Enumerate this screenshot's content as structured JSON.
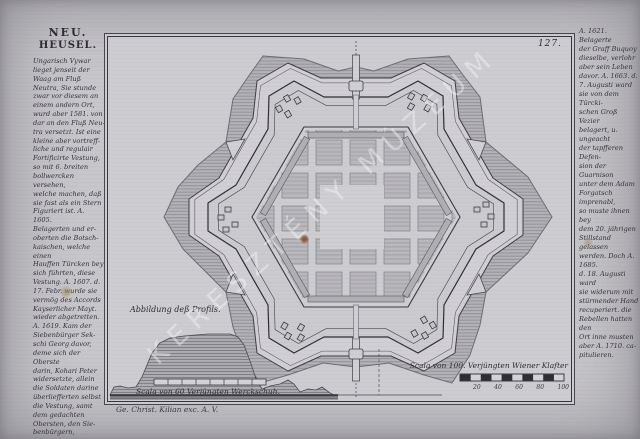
{
  "page": {
    "number": "127."
  },
  "title": {
    "line1": "NEU.",
    "line2": "HEUSEL."
  },
  "left_column": {
    "text": "Ungarisch Vywar\nlieget jenseit der\nWaag am Fluß\nNeutra, Sie stunde\nzwar vor diesem an\neinem andern Ort,\nwurd aber 1581. von\ndar an den Fluß Neu-\ntra versetzt. Ist eine\nkleine aber vortreff-\nliche und regulair\nFortificirte Vestung,\nso mit 6. breiten\nbollwercken versehen,\nwelche machen, daß\nsie fast als ein Stern\nFiguriert ist. A. 1605.\nBelagerten und er-\noberten die Botsch-\nkaischen, welche einen\nHauffen Türcken bey\nsich führten, diese\nVestung. A. 1607. d.\n17. Febr. wurde sie\nvermög des Accords\nKayserlicher Mayt.\nwieder abgetretten.\nA. 1619. Kam der\nSiebenbürger Sek-\nschi Georg davor,\ndeme sich der Oberste\ndarin, Kohari Peter\nwidersetzte, allein\ndie Soldaten darine\nüberliefferten selbst\ndie Vestung, samt\ndem gedachten\nObersten, den Sie-\nbenbürgern,"
  },
  "right_column": {
    "text": "A. 1621. Belagerte\nder Graff Buquoy\ndieselbe, verlohr\naber sein Leben\ndavor. A. 1663. d.\n7. Augusti ward\nsie von dem Türcki-\nschen Groß Vezier\nbelagert, u. ungeacht\nder tapfferen Defen-\nsion der Guarnison\nunter dem Adam\nForgatsch imprenabl,\nso muste ihnen bey\ndem 20. jährigen\nStillstand gelassen\nwerden. Doch A. 1685.\nd. 18. Augusti ward\nsie widerum mit\nstürmender Hand\nrecuperiert. die\nRebellen hatten den\nOrt inne musten\naber A. 1710. ca-\npitulieren."
  },
  "profile": {
    "caption": "Abbildung deß Profils.",
    "scale_label": "Scala von 60 Verjüngten Werckschuh."
  },
  "scale_right": {
    "label": "Scala von 100. Verjüngten Wiener Klafter",
    "ticks": [
      "20",
      "40",
      "60",
      "80",
      "100"
    ]
  },
  "imprint": {
    "text": "Ge. Christ. Kilian exc. A. V."
  },
  "watermark": {
    "text": "KERESZTÉNY MÚZEUM"
  },
  "colors": {
    "paper": "#cdccd1",
    "page_paper": "#c7c6ca",
    "ink": "#2d2b31",
    "hatch": "#8f8e92",
    "foxing": "#8a522a"
  }
}
